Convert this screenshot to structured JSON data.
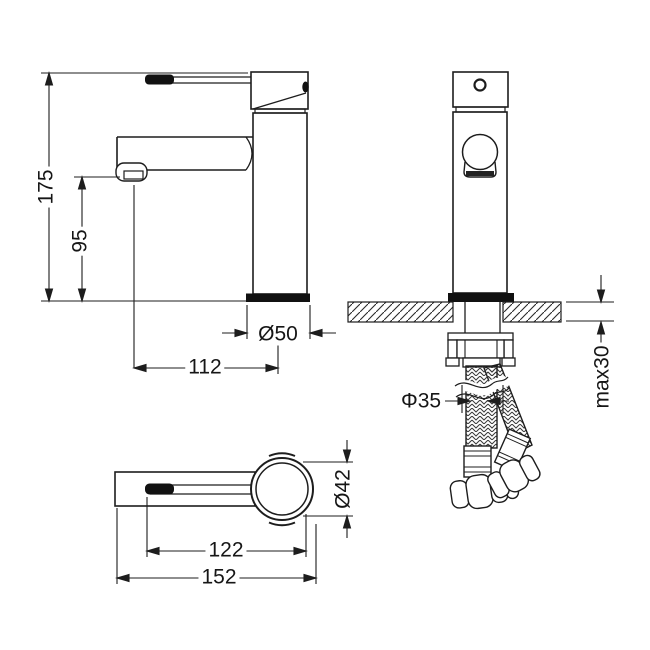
{
  "colors": {
    "line": "#1d1d1d",
    "background": "#ffffff",
    "solid_fill": "#111111"
  },
  "dimensions": {
    "total_height": "175",
    "spout_height": "95",
    "base_diameter": "Ø50",
    "spout_reach": "112",
    "hole_diameter": "Φ35",
    "max_counter_thickness": "max30",
    "body_diameter": "Ø42",
    "handle_reach": "122",
    "overall_length": "152"
  }
}
